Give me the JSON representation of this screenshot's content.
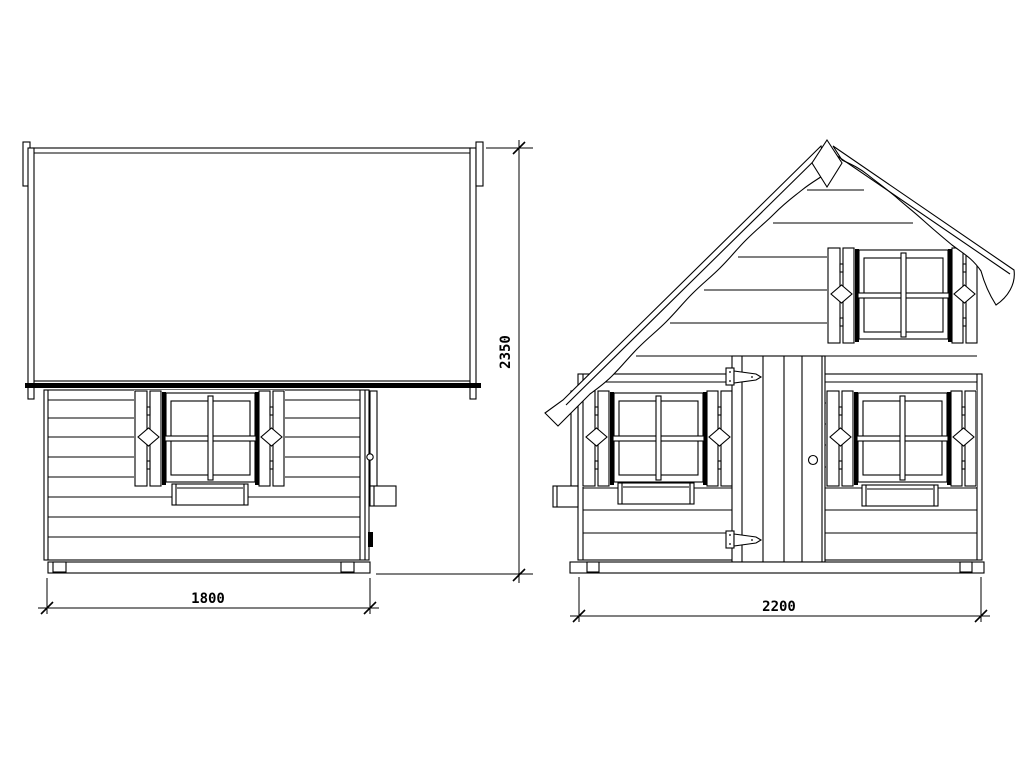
{
  "drawing": {
    "type": "technical elevation drawing",
    "background_color": "#ffffff",
    "line_color": "#000000",
    "dimensions": {
      "side_view_width": {
        "value": "1800"
      },
      "overall_height": {
        "value": "2350"
      },
      "front_view_width": {
        "value": "2200"
      }
    }
  }
}
